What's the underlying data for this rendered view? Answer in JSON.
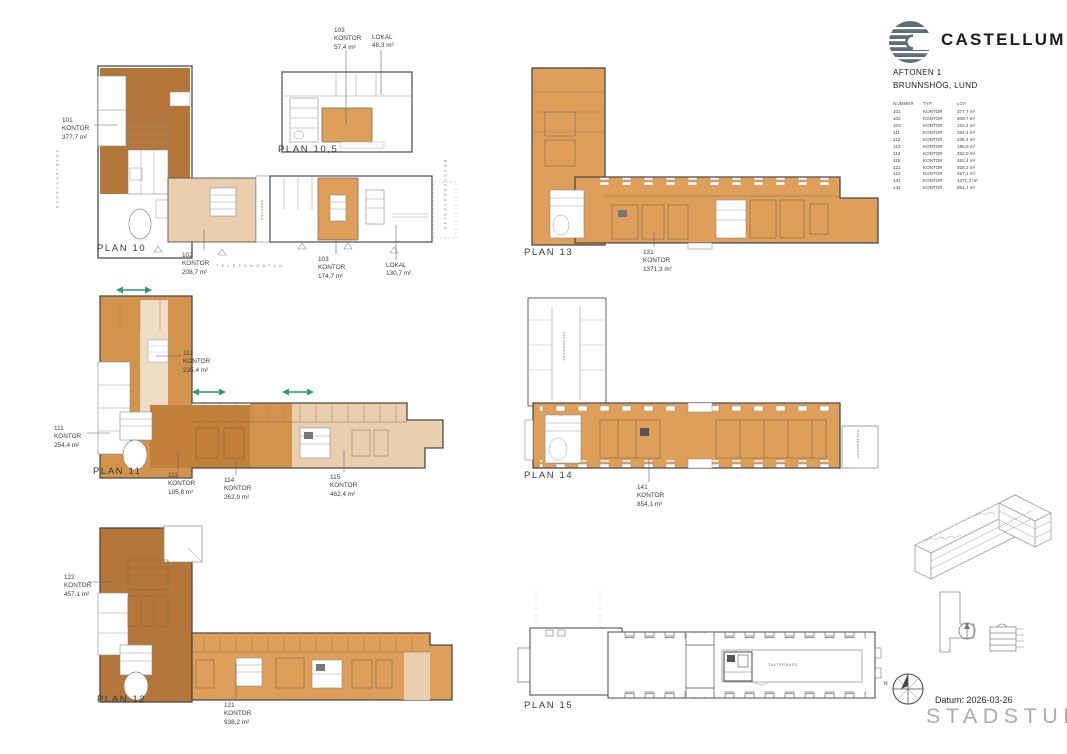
{
  "header": {
    "brand": "CASTELLUM",
    "project": "AFTONEN 1",
    "location": "BRUNNSHÖG, LUND",
    "table": {
      "columns": [
        "NUMMER",
        "TYP",
        "LOA"
      ],
      "rows": [
        [
          "101",
          "KONTOR",
          "377,7 m²"
        ],
        [
          "102",
          "KONTOR",
          "208,7 m²"
        ],
        [
          "103",
          "KONTOR",
          "232,1 m²"
        ],
        [
          "111",
          "KONTOR",
          "254,4 m²"
        ],
        [
          "112",
          "KONTOR",
          "235,4 m²"
        ],
        [
          "113",
          "KONTOR",
          "195,8 m²"
        ],
        [
          "114",
          "KONTOR",
          "262,0 m²"
        ],
        [
          "115",
          "KONTOR",
          "462,4 m²"
        ],
        [
          "121",
          "KONTOR",
          "938,2 m²"
        ],
        [
          "122",
          "KONTOR",
          "457,1 m²"
        ],
        [
          "131",
          "KONTOR",
          "1371,3 m²"
        ],
        [
          "141",
          "KONTOR",
          "854,1 m²"
        ]
      ]
    }
  },
  "plans": {
    "p10": "PLAN 10",
    "p105": "PLAN 10,5",
    "p11": "PLAN 11",
    "p12": "PLAN 12",
    "p13": "PLAN 13",
    "p14": "PLAN 14",
    "p15": "PLAN 15"
  },
  "annotations": {
    "a101": {
      "num": "101",
      "typ": "KONTOR",
      "area": "377,7 m²"
    },
    "a102": {
      "num": "102",
      "typ": "KONTOR",
      "area": "208,7 m²"
    },
    "a103p10": {
      "num": "103",
      "typ": "KONTOR",
      "area": "174,7 m²"
    },
    "lokalp10": {
      "typ": "LOKAL",
      "area": "130,7 m²"
    },
    "a103p105": {
      "num": "103",
      "typ": "KONTOR",
      "area": "57,4 m²"
    },
    "lokalp105": {
      "typ": "LOKAL",
      "area": "48,3 m²"
    },
    "a111": {
      "num": "111",
      "typ": "KONTOR",
      "area": "254,4 m²"
    },
    "a112": {
      "num": "112",
      "typ": "KONTOR",
      "area": "235,4 m²"
    },
    "a113": {
      "num": "113",
      "typ": "KONTOR",
      "area": "195,8 m²"
    },
    "a114": {
      "num": "114",
      "typ": "KONTOR",
      "area": "262,0 m²"
    },
    "a115": {
      "num": "115",
      "typ": "KONTOR",
      "area": "462,4 m²"
    },
    "a121": {
      "num": "121",
      "typ": "KONTOR",
      "area": "938,2 m²"
    },
    "a122": {
      "num": "122",
      "typ": "KONTOR",
      "area": "457,1 m²"
    },
    "a131": {
      "num": "131",
      "typ": "KONTOR",
      "area": "1371,3 m²"
    },
    "a141": {
      "num": "141",
      "typ": "KONTOR",
      "area": "854,1 m²"
    }
  },
  "streets": {
    "left": "SOLBJERSVÄGEN",
    "bottom": "TELEFONGATAN",
    "right": "BRUNNSHÖGSGATAN",
    "passage": "PASSAGE"
  },
  "terrace_label": "TAKTERRASS",
  "compass_north": "N",
  "footer": {
    "datum": "Datum: 2026-03-26",
    "studio": "STADSTUDIO"
  },
  "colors": {
    "dark": "#b5763a",
    "dark2": "#c3803a",
    "mid": "#d2944c",
    "light": "#dd9f5a",
    "tan": "#e9cfad",
    "pale": "#eedcc4",
    "teal": "#2f9c77",
    "logo": "#5d6e79",
    "studio": "#a8adb0"
  }
}
